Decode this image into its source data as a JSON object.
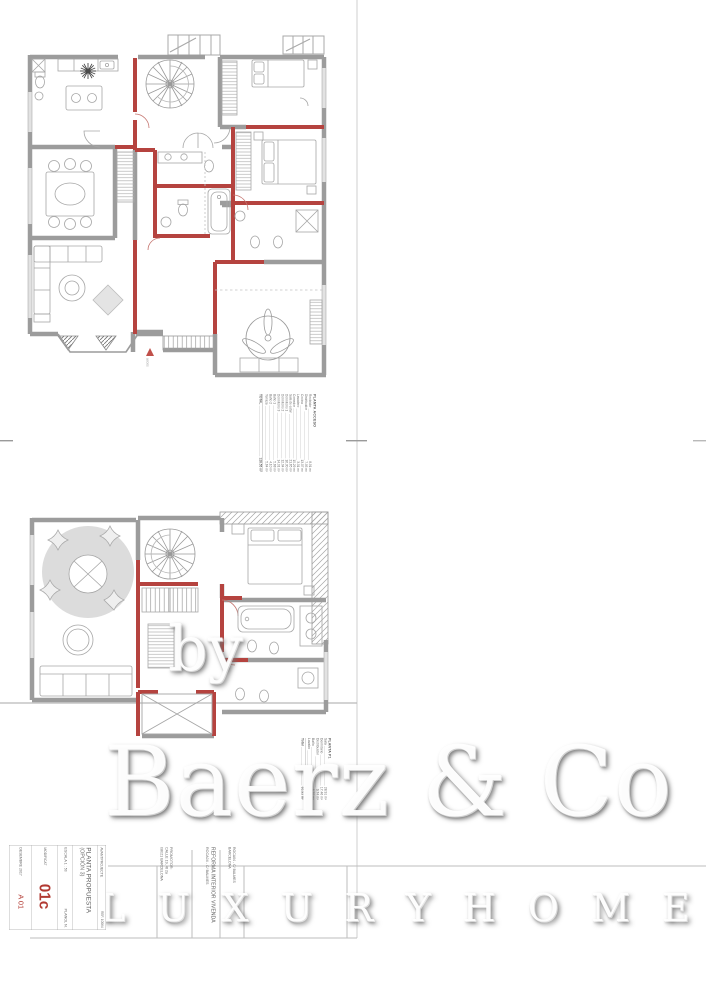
{
  "watermark": {
    "by": "by",
    "brand": "Baerz & Co",
    "tagline": "L U X U R Y   H O M E S"
  },
  "colors": {
    "reform_red": "#b5433f",
    "accent_red": "#b23a32",
    "wall_gray": "#9c9c9c"
  },
  "plan_labels": {
    "access_label": "accés"
  },
  "table_acceso": {
    "title": "PLANTA ACCESO",
    "rows": [
      {
        "label": "Recibidor",
        "value": "8.91 m²"
      },
      {
        "label": "Distribuidor",
        "value": "7.95 m²"
      },
      {
        "label": "Cocina",
        "value": "13.07 m²"
      },
      {
        "label": "Lavadero",
        "value": "3.01 m²"
      },
      {
        "label": "Comedor",
        "value": "15.29 m²"
      },
      {
        "label": "Sala de estar",
        "value": "21.65 m²"
      },
      {
        "label": "Dormitorio 1",
        "value": "16.30 m²"
      },
      {
        "label": "Dormitorio 2",
        "value": "12.04 m²"
      },
      {
        "label": "Dormitorio 3",
        "value": "14.91 m²"
      },
      {
        "label": "Baño 1",
        "value": "5.68 m²"
      },
      {
        "label": "Baño 2",
        "value": "4.10 m²"
      },
      {
        "label": "Terraza",
        "value": "5.64 m²"
      }
    ],
    "total_label": "TOTAL",
    "total_value": "128.55 m²"
  },
  "table_p1": {
    "title": "PLANTA P1",
    "rows": [
      {
        "label": "Sala",
        "value": "28.91 m²"
      },
      {
        "label": "Dormitorio",
        "value": "17.46 m²"
      },
      {
        "label": "Distribuidor",
        "value": "9.74 m²"
      },
      {
        "label": "Baño",
        "value": "6.70 m²"
      },
      {
        "label": "Lavabo",
        "value": "3.12 m²"
      }
    ],
    "total_label": "Total",
    "total_value": "65.93 m²"
  },
  "titleblock": {
    "project_type": "AVANTPROJECTE",
    "ref": "REF. 10064",
    "title": "PLANTA PROPUESTA",
    "subtitle": "(OPCIÓN 3)",
    "scale_label": "ESCALA  1 : 50",
    "sheet_label": "PLANOL N.",
    "modified_label": "MODIFICAT",
    "sheet_code": "01c",
    "date": "DESEMBRE 2017",
    "sheet_code2": "A 01",
    "promoter_label": "PROMOTOR:",
    "promoter_line1": "CALLE 19, 4t 2a",
    "promoter_line2": "08021 BARCELONA",
    "project_name": "REFORMA INTERIOR VIVENDA",
    "project_ref": "ROCA04 - C/ BALMES",
    "project_ref2": "BARCELONA"
  }
}
